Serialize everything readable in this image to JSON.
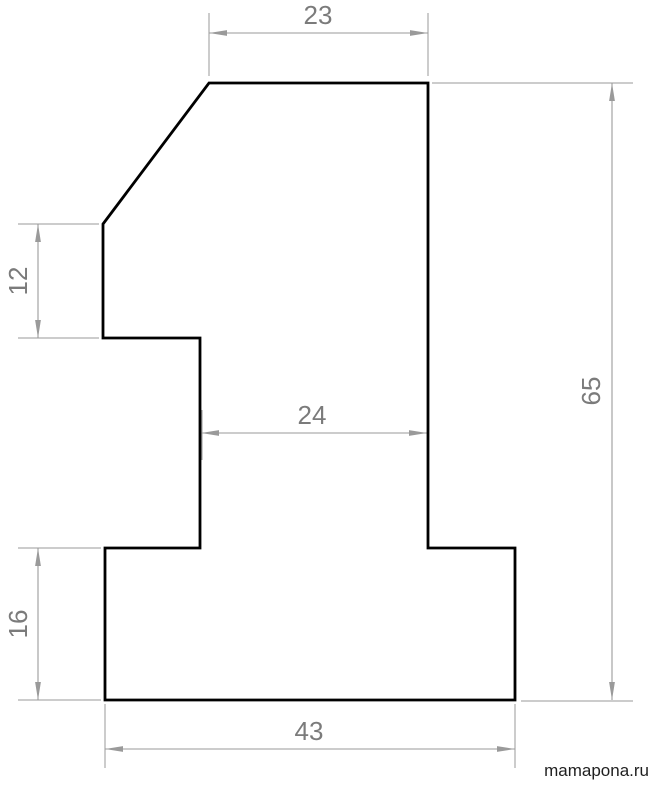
{
  "figure": {
    "shape": "digit-1-outline"
  },
  "dimensions": {
    "top_width": "23",
    "upper_left_height": "12",
    "stem_width": "24",
    "base_height": "16",
    "base_width": "43",
    "overall_height": "65"
  },
  "watermark": "mamapona.ru",
  "colors": {
    "outline": "#000000",
    "dimension_lines": "#9a9a9a",
    "dimension_text": "#7b7b7b",
    "watermark_text": "#1f1f1f",
    "background": "#ffffff"
  }
}
